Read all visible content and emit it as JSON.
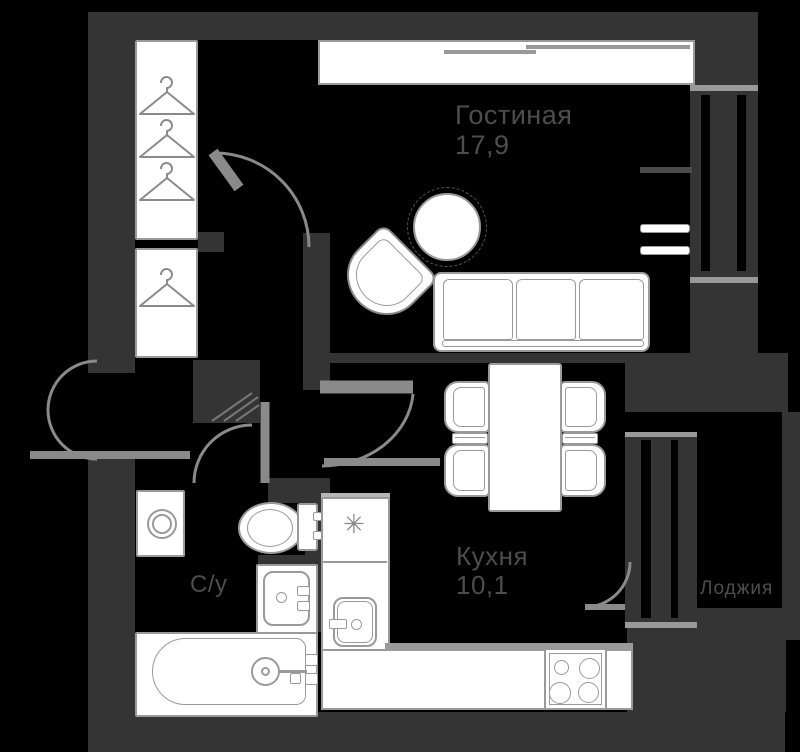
{
  "title": "apartment-floor-plan",
  "colors": {
    "background": "#000000",
    "wall": "#343434",
    "line": "#8a8a8a",
    "outline": "#9a9a9a",
    "edge": "#999999",
    "hatch": "#777777",
    "text": "#4d4d4d"
  },
  "rooms": {
    "living": {
      "name": "Гостиная",
      "area": "17,9"
    },
    "kitchen": {
      "name": "Кухня",
      "area": "10,1",
      "vent_symbol": "✳"
    },
    "bathroom": {
      "name": "С/у"
    },
    "loggia": {
      "name": "Лоджия"
    }
  },
  "icons": {
    "hanger": "hanger-icon",
    "vent": "vent-star-icon",
    "stove": "stove-burners-icon"
  }
}
